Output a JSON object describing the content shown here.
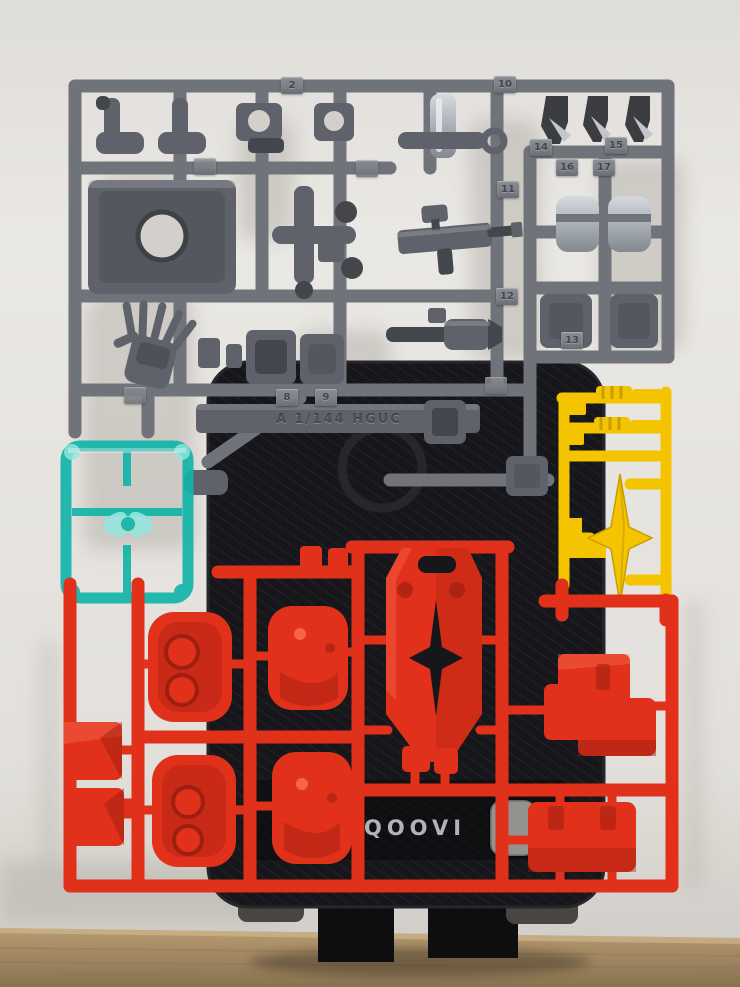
{
  "photo_text": {
    "brand_on_stand": "QOOVI",
    "runner_plate_label": "A 1/144 HGUC"
  },
  "part_tags": [
    "2",
    "8",
    "9",
    "10",
    "11",
    "12",
    "13",
    "14",
    "15",
    "16",
    "17"
  ],
  "colors": {
    "wall": "#e7e5e1",
    "wall-dark": "#d3d0cb",
    "wall-shadow": "#a19c94",
    "desk": "#ab9168",
    "desk-dark": "#846c4b",
    "desk-line": "#8d7452",
    "stand": "#17171b",
    "stand-edge": "#26262c",
    "leg": "#0e0e11",
    "leg-pad": "#4b4542",
    "gray": "#70737a",
    "gray-part": "#5f626a",
    "gray-dark": "#43464c",
    "gray-light": "#a3a6ad",
    "silver": "#c3c6cc",
    "teal": "#12b5a9",
    "teal-light": "#8fe9e0",
    "yellow": "#f5c400",
    "yellow-dark": "#c79e00",
    "red": "#e1311b",
    "red-dark": "#9e1f10",
    "red-light": "#ff7a5e",
    "tag-face": "#7e8188",
    "tag-text": "#43464c",
    "brand": "#c3c6ca",
    "hole": "#e2e0db"
  }
}
